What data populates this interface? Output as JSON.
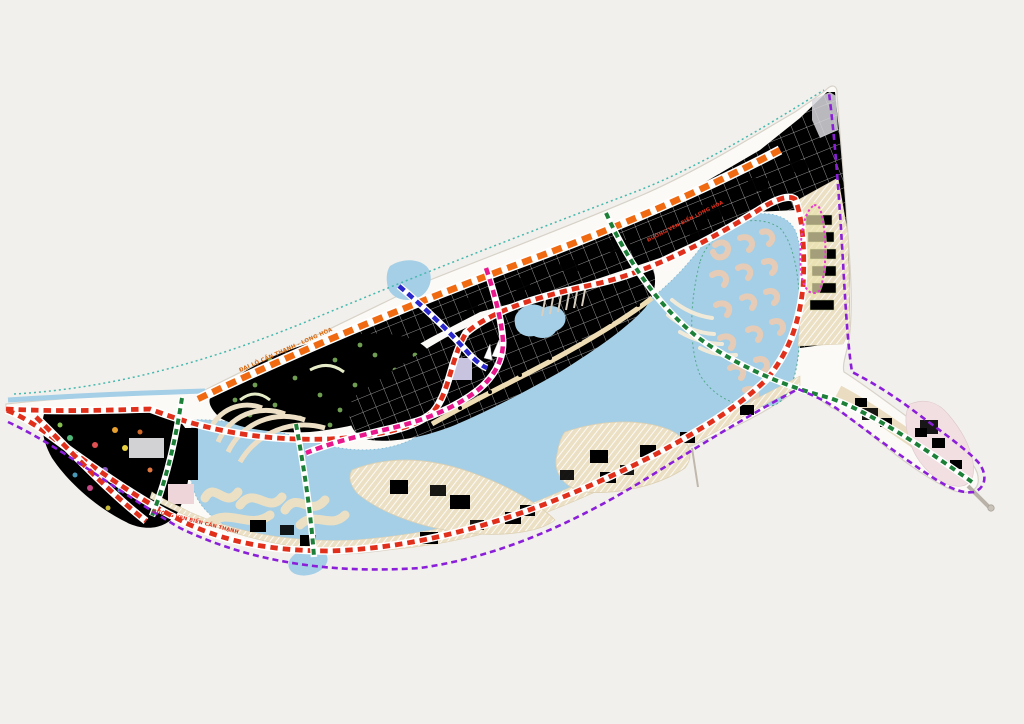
{
  "map": {
    "background": "#f2f0ec",
    "land_fill": "#fbfaf6",
    "coast_stroke": "#d8d3c9",
    "water": "#a5cfe6",
    "lagoon_outline": "#55a98e",
    "road_labels": {
      "boulevard": "ĐẠI LỘ CẦN THẠNH - LONG HÒA",
      "coastal_west": "ĐƯỜNG VEN BIỂN CẦN THẠNH",
      "coastal_east": "ĐƯỜNG VEN BIỂN LONG HÒA"
    },
    "routes": {
      "boulevard": {
        "color": "#f06a12"
      },
      "ring_road": {
        "color": "#e0301c"
      },
      "park_road": {
        "color": "#e0301c"
      },
      "magenta_road": {
        "color": "#e8188c"
      },
      "blue_road": {
        "color": "#2a28cc"
      },
      "green_scenic": {
        "color": "#1d8038"
      },
      "boundary": {
        "color": "#8b1fd9"
      },
      "coastline": {
        "color": "#45b8ae"
      },
      "marina_loop": {
        "color": "#e83bd0"
      }
    },
    "districts": {
      "golf_course": {
        "color": "#a8c37e"
      },
      "theme_park": {
        "color": "#cde0b6"
      },
      "central_blocks": {
        "color": "#f1ced5"
      },
      "north_plots": {
        "color": "#e6efd6"
      },
      "northeast_plots": {
        "color": "#dcebc6"
      },
      "island_plots": {
        "color": "#ece0c4"
      },
      "lavender_blocks": {
        "color": "#b9cbe6"
      },
      "park_green": {
        "color": "#83b765"
      },
      "pink_blocks": {
        "color": "#f0c8ce"
      },
      "olive_rows": {
        "color": "#d9dfae"
      }
    }
  }
}
